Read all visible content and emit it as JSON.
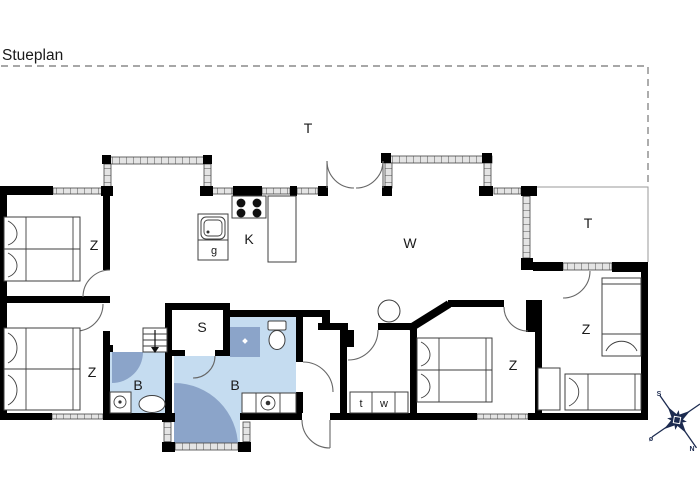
{
  "title": "Stueplan",
  "rooms": {
    "terrace_top": {
      "label": "T"
    },
    "terrace_right": {
      "label": "T"
    },
    "bedroom_nw": {
      "label": "Z"
    },
    "bedroom_sw": {
      "label": "Z"
    },
    "bedroom_s": {
      "label": "Z"
    },
    "bedroom_se": {
      "label": "Z"
    },
    "kitchen": {
      "label": "K"
    },
    "kitchen_g": {
      "label": "g"
    },
    "living": {
      "label": "W"
    },
    "room_s": {
      "label": "S"
    },
    "bath_main": {
      "label": "B"
    },
    "bath_small": {
      "label": "B"
    },
    "utility_t": {
      "label": "t"
    },
    "utility_w": {
      "label": "w"
    }
  },
  "compass": {
    "south": "S",
    "north": "N",
    "east": "ø"
  },
  "colors": {
    "wall": "#000000",
    "window_fill": "#e4e4e4",
    "bath_floor": "#c5dcf0",
    "bath_accent": "#8ba4c9",
    "compass": "#1c2b50",
    "boundary_dash": "#8a8a8a"
  }
}
